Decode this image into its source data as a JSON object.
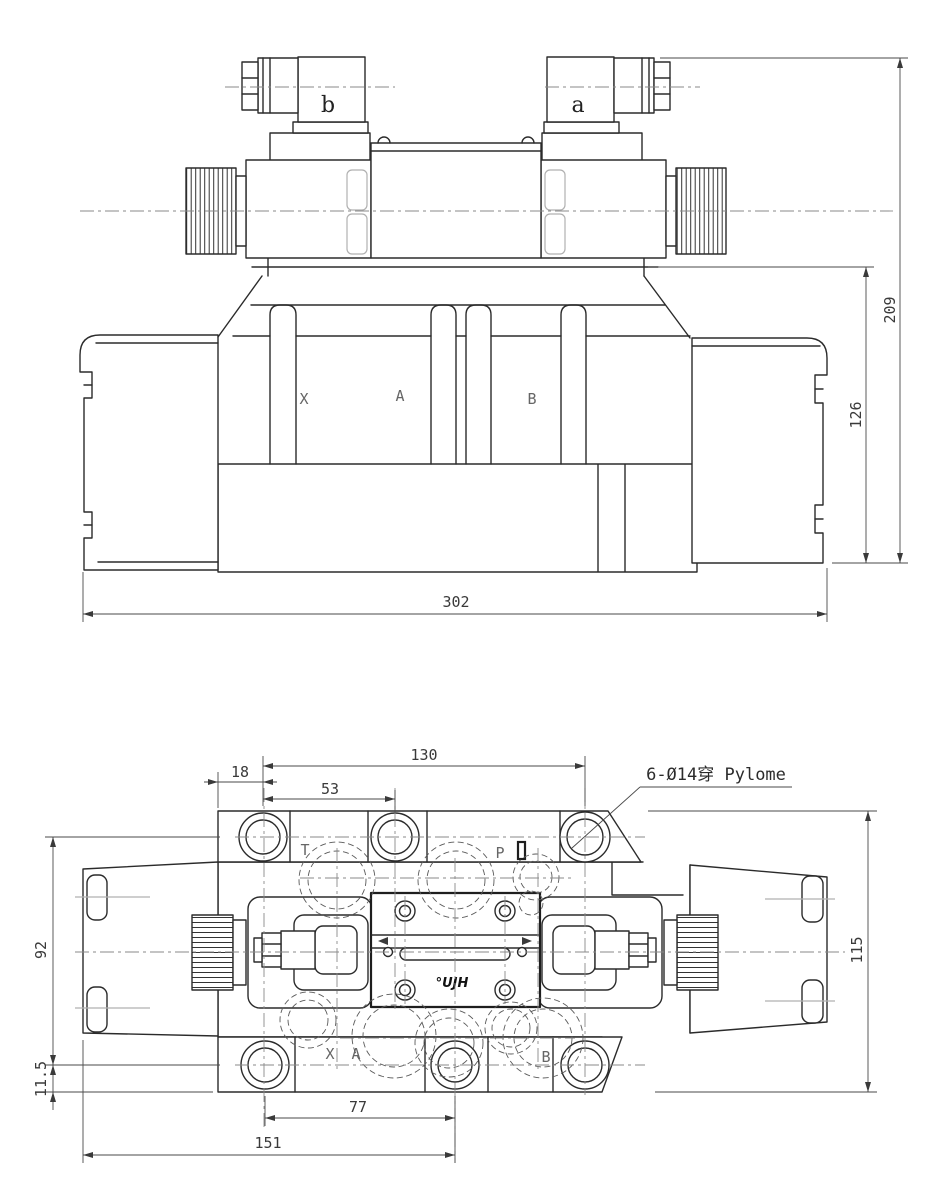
{
  "drawing": {
    "kind": "hydraulic solenoid directional valve dimension drawing",
    "top": {
      "connector_b": "b",
      "connector_a": "a",
      "port_x": "X",
      "port_a": "A",
      "port_b": "B",
      "dim_total_height": "209",
      "dim_body_height": "126",
      "dim_total_width": "302"
    },
    "bottom": {
      "port_t": "T",
      "port_p": "P",
      "port_x": "X",
      "port_a": "A",
      "port_b": "B",
      "callout": "6-Ø14穿 Pylome",
      "logo": "°UJH",
      "dim_hole_span_h": "130",
      "dim_edge_offset": "18",
      "dim_hole_pitch": "53",
      "dim_hole_span_v": "92",
      "dim_bottom_offset": "11.5",
      "dim_overall_height": "115",
      "dim_lower_pitch": "77",
      "dim_lower_span": "151"
    },
    "colors": {
      "line": "#2b2b2b",
      "dimension": "#4a4a4a",
      "centerline": "#8a8a8a",
      "hidden": "#5a5a5a",
      "background": "#ffffff"
    }
  }
}
